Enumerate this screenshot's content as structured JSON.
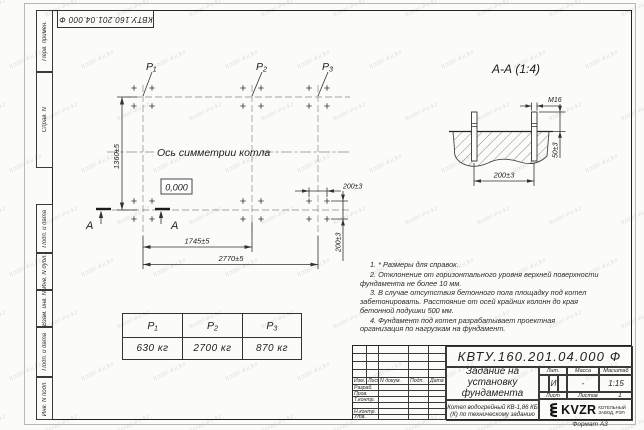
{
  "watermark": "kotel-kv.kz",
  "stamp": {
    "doc_number_inverted": "КВТУ.160.201.04.000 Ф"
  },
  "sidebar": {
    "items": [
      "Перв. примен.",
      "Справ. N",
      "Подп. и дата",
      "Инв. N дубл.",
      "Взам. инв. N",
      "Подп. и дата",
      "Инв. N подл."
    ]
  },
  "plan": {
    "load_labels": [
      "P₁",
      "P₂",
      "P₃"
    ],
    "symmetry_label": "Ось симметрии котла",
    "elevation_mark": "0,000",
    "dim_vertical": "1360±5",
    "dim_inner": "1745±5",
    "dim_outer": "2770±5",
    "dim_bolt_x": "200±3",
    "dim_bolt_y": "200±3",
    "section_letter": "А"
  },
  "section_view": {
    "title": "А-А (1:4)",
    "thread_label": "М16",
    "dim_protrusion": "50±3",
    "dim_spacing": "200±3"
  },
  "loads_table": {
    "headers": [
      "P₁",
      "P₂",
      "P₃"
    ],
    "values": [
      "630 кг",
      "2700 кг",
      "870 кг"
    ]
  },
  "notes": [
    "1. * Размеры для справок.",
    "2. Отклонение от горизонтального уровня верхней поверхности фундамента не более 10 мм.",
    "3. В случае отсутствия бетонного пола площадку под котел забетонировать. Расстояние от осей крайних колонн до края бетонной подушки 500 мм.",
    "4. Фундамент под котел разрабатывает проектная организация по нагрузкам на фундамент."
  ],
  "title_block": {
    "doc_number": "КВТУ.160.201.04.000 Ф",
    "col_headers": [
      "Изм.",
      "Лист",
      "N докум.",
      "Подп.",
      "Дата"
    ],
    "row_labels": [
      "Разраб.",
      "Пров.",
      "Т.контр.",
      "",
      "Н.контр.",
      "Утв."
    ],
    "title": "Задание на установку фундамента",
    "product": "Котел водогрейный КВ-1,86 КБ (К) по техническому заданию",
    "lit_header": "Лит.",
    "lit_value": "И",
    "mass_header": "Масса",
    "mass_value": "-",
    "scale_header": "Масштаб",
    "scale_value": "1:15",
    "sheet_label": "Лист",
    "sheets_label": "Листов",
    "sheets_value": "1",
    "logo_text": "KVZR",
    "logo_line1": "КОТЕЛЬНЫЙ",
    "logo_line2": "ЗАВОД, РЭП",
    "format_label": "Формат А3"
  }
}
